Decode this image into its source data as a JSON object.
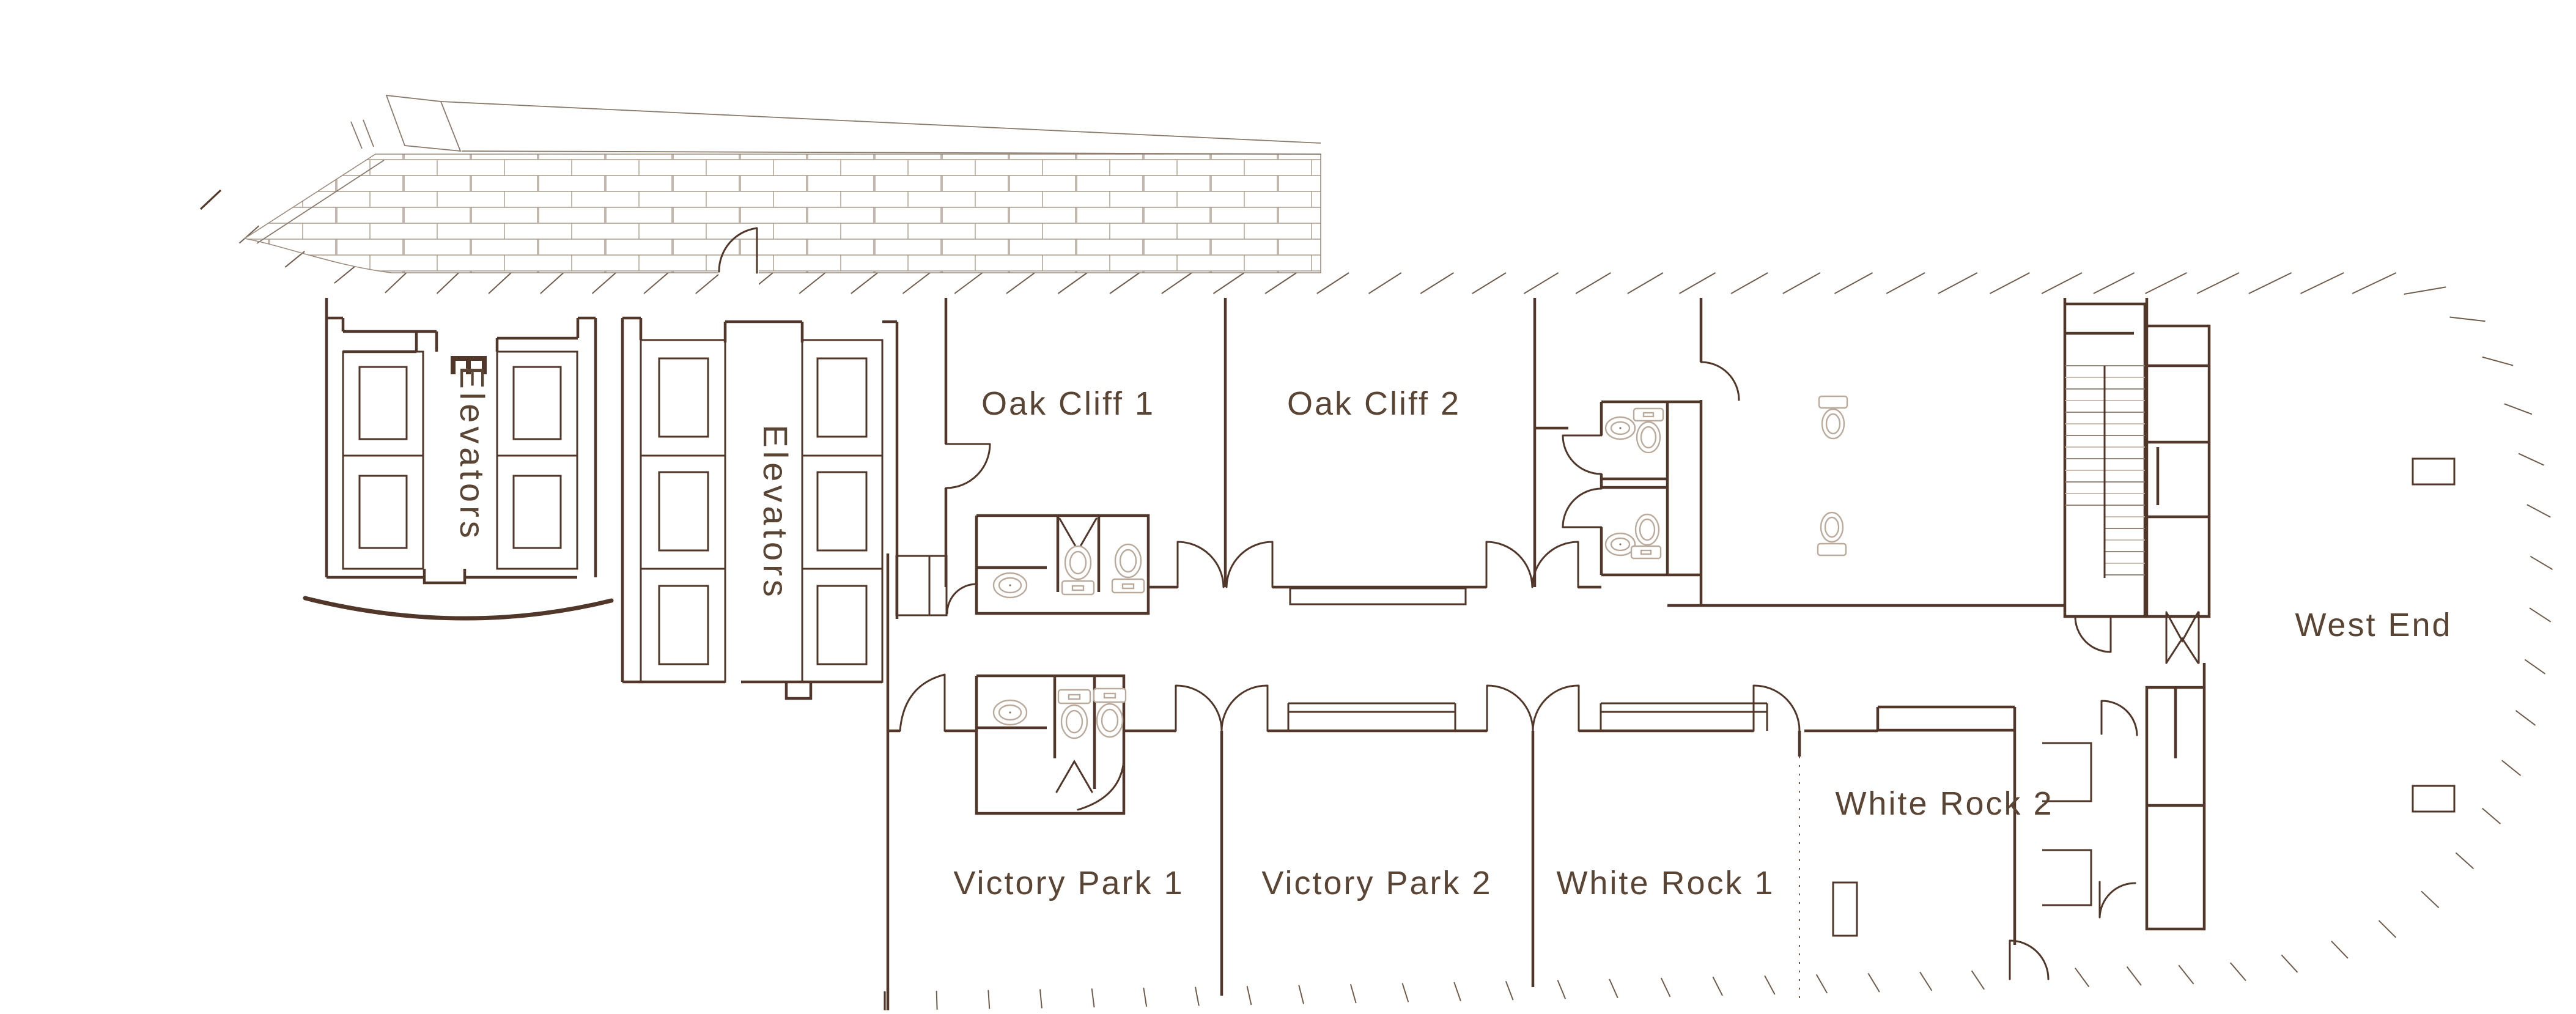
{
  "plan": {
    "rooms": [
      {
        "id": "oak-cliff-1",
        "label": "Oak Cliff 1"
      },
      {
        "id": "oak-cliff-2",
        "label": "Oak Cliff 2"
      },
      {
        "id": "victory-park-1",
        "label": "Victory Park 1"
      },
      {
        "id": "victory-park-2",
        "label": "Victory Park 2"
      },
      {
        "id": "white-rock-1",
        "label": "White Rock 1"
      },
      {
        "id": "white-rock-2",
        "label": "White Rock 2"
      },
      {
        "id": "west-end",
        "label": "West End"
      }
    ],
    "elevator_banks": [
      {
        "id": "elevator-bank-1",
        "label": "Elevators",
        "shafts": 4
      },
      {
        "id": "elevator-bank-2",
        "label": "Elevators",
        "shafts": 6
      }
    ],
    "fixtures": {
      "toilets": 8,
      "sinks": 4,
      "staircases": 1,
      "columns": 2
    }
  },
  "colors": {
    "background": "#ffffff",
    "wall": "#503729",
    "wall_light": "#8a7665",
    "fixture": "#b9aa9c",
    "brick": "#a89a8c",
    "ink": "#5a4434"
  }
}
